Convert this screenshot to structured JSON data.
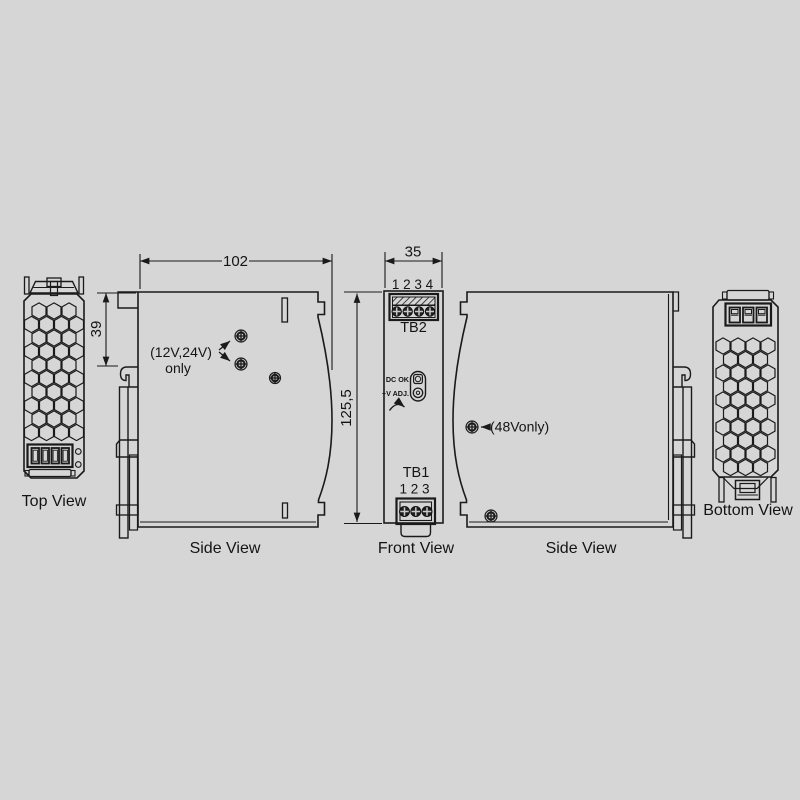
{
  "drawing": {
    "type": "mechanical-dimension-drawing",
    "colors": {
      "background": "#d6d6d6",
      "line": "#1a1a1a"
    },
    "views": {
      "top": {
        "label": "Top View"
      },
      "side_left": {
        "label": "Side View",
        "note_line1": "(12V,24V)",
        "note_line2": "only"
      },
      "front": {
        "label": "Front View",
        "tb2_name": "TB2",
        "tb2_pins": "1 2 3 4",
        "indicator_led": "DC OK",
        "indicator_pot": "+V ADJ.",
        "tb1_name": "TB1",
        "tb1_pins": "1 2 3"
      },
      "side_right": {
        "label": "Side View",
        "note": "(48Vonly)"
      },
      "bottom": {
        "label": "Bottom View"
      }
    },
    "dimensions": {
      "overall_depth": "102",
      "rail_offset": "39",
      "overall_width": "35",
      "overall_height": "125,5"
    }
  }
}
